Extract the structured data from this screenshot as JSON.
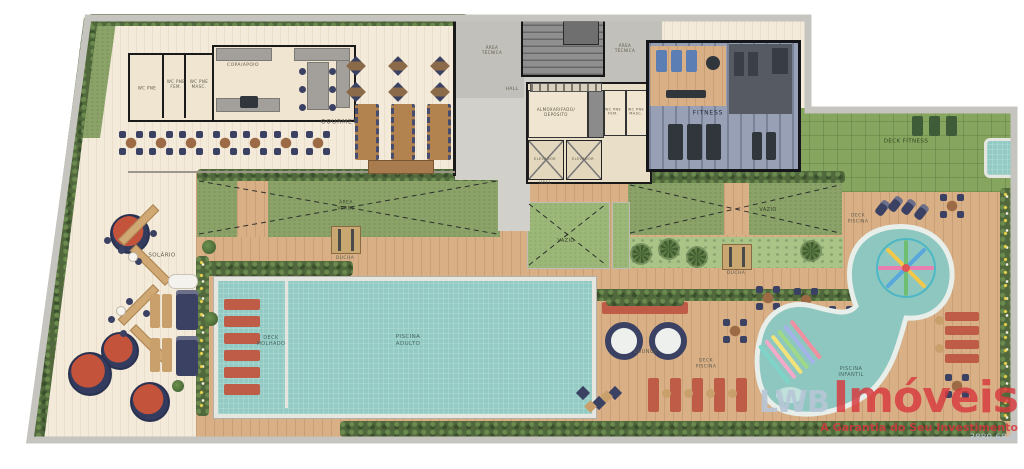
{
  "labels": {
    "wc_pne": "WC PNE",
    "wc_pne_fem": "WC PNE FEM.",
    "wc_pne_masc": "WC PNE MASC.",
    "copa_apoio": "COPA/APOIO",
    "gourmet": "GOURMET",
    "area_tecnica": "ÁREA TÉCNICA",
    "hall": "HALL",
    "almoxarifado": "ALMOXARIFADO/ DEPÓSITO",
    "elevador": "ELEVADOR",
    "fitness": "FITNESS",
    "deck_fitness": "DECK FITNESS",
    "solario": "SOLÁRIO",
    "area_verde": "ÁREA VERDE",
    "vazio": "VAZIO",
    "ducha": "DUCHA",
    "piscina_adulto": "PISCINA ADULTO",
    "deck_molhado": "DECK MOLHADO",
    "lounge": "LOUNGE",
    "deck_piscina": "DECK PISCINA",
    "piscina_infantil": "PISCINA INFANTIL"
  },
  "watermark": {
    "prefix": "LWB",
    "brand": "Imóveis",
    "tagline": "A Garantia do Seu Investimento",
    "phone": "3889.6836"
  },
  "colors": {
    "wall": "#c6c4be",
    "deck_wood": "#d9b086",
    "cream_floor": "#f3ead9",
    "lawn": "#8ba368",
    "hedge": "#51683c",
    "pool_tile": "#93cbc4",
    "fitness_floor": "#97a0b4",
    "lounger_red": "#bf5c48",
    "furniture_navy": "#3b4163",
    "watermark_red": "#d8393e"
  }
}
